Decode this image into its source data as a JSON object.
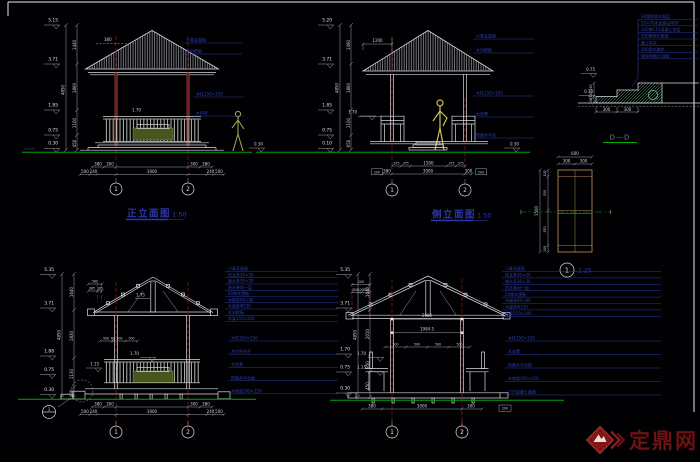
{
  "views": {
    "front": {
      "title": "正立面图",
      "scale": "1:50",
      "levels": [
        "5.15",
        "3.71",
        "1.85",
        "0.75",
        "0.30"
      ],
      "vtotal": "4850",
      "vdims": [
        "1440",
        "1860",
        "1100",
        "450"
      ],
      "roof_dim": "380",
      "rail_level": "1.70",
      "ground_left": "±0.00",
      "ground_right": "0.30",
      "hdims1": [
        "380",
        "300",
        "300",
        "380"
      ],
      "hdims2": [
        "500",
        "240",
        "3000",
        "240",
        "500"
      ],
      "axes": [
        "1",
        "2"
      ],
      "notes_roof": [
        "小青瓦屋面",
        "木封檐板"
      ],
      "notes_body": [
        "木柱150×150",
        "木栏杆"
      ]
    },
    "side": {
      "title": "侧立面图",
      "scale": "1:50",
      "levels": [
        "5.20",
        "3.71",
        "1.85",
        "0.75",
        "0.10"
      ],
      "vtotal": "4850",
      "vdims": [
        "1490",
        "1860",
        "1100",
        "650"
      ],
      "overhang": "1200",
      "rail_level": "1.70",
      "ground_right": "0.30",
      "hdims1": [
        "375",
        "375",
        "1500",
        "375",
        "375"
      ],
      "hdims2": [
        "380",
        "3000",
        "300"
      ],
      "end_box": "200",
      "axes": [
        "1",
        "2"
      ],
      "notes_roof": [
        "小青瓦屋面",
        "木封檐板"
      ],
      "notes_body": [
        "木柱150×150",
        "木坐凳",
        "防腐木平台"
      ]
    },
    "stair": {
      "title": "D—D",
      "levels": [
        "0.75",
        "0.30"
      ],
      "hdims": [
        "300",
        "300"
      ],
      "vdims": [
        "150",
        "150",
        "150"
      ],
      "notes": [
        "30厚防腐木面层",
        "50×70木龙骨@400",
        "100厚C15混凝土垫层",
        "150厚碎石垫层",
        "素土夯实",
        "300宽木踏步",
        "绿化种植土回填"
      ]
    },
    "column": {
      "bubble": "1",
      "scale": "1:25",
      "top_total": "600",
      "top_dims": [
        "300",
        "300"
      ],
      "side_total": "1500",
      "side_dims": [
        "100",
        "550",
        "550",
        "100"
      ]
    },
    "sec1": {
      "levels": [
        "5.35",
        "3.71",
        "1.88",
        "0.75",
        "0.30"
      ],
      "vtotal": "4850",
      "vdims": [
        "1640",
        "1830",
        "1130",
        "450"
      ],
      "top_dim": "560",
      "top_dims": [
        "385",
        "165"
      ],
      "slope": "1.75",
      "mid_dims": [
        "500",
        "60",
        "500",
        "500"
      ],
      "rail_levels": [
        "1.70",
        "1.15"
      ],
      "hdims1": [
        "380",
        "300",
        "300",
        "380"
      ],
      "hdims2": [
        "500",
        "240",
        "3000",
        "240",
        "500"
      ],
      "axes": [
        "1",
        "2"
      ],
      "detail_bubble": "1",
      "notes_roof": [
        "小青瓦屋面",
        "挂瓦条30×30",
        "顺水条30×30",
        "防水卷材一层",
        "20厚木望板",
        "木椽条60×80",
        "木檩条Φ120",
        "木封檐板",
        "木梁150×200"
      ],
      "notes_body": [
        "木柱150×150",
        "木栏杆扶手",
        "木坐凳",
        "防腐木平台板",
        "木地梁100×150"
      ]
    },
    "sec2": {
      "levels": [
        "5.35",
        "3.71",
        "1.70",
        "0.75",
        "0.30"
      ],
      "vtotal": "4850",
      "vdims": [
        "1640",
        "2010",
        "950",
        "450"
      ],
      "top_dim": "100",
      "top_dims": [
        "300",
        "100",
        "300"
      ],
      "inner_dims": [
        "2000",
        "1984.5"
      ],
      "seat_dims": [
        "500",
        "500",
        "500",
        "500"
      ],
      "rail_levels": [
        "1.70",
        "1.15"
      ],
      "hdims": [
        "380",
        "3000",
        "300"
      ],
      "end_box": "200",
      "axes": [
        "1",
        "2"
      ],
      "notes_roof": [
        "小青瓦屋面",
        "挂瓦条30×30",
        "顺水条30×30",
        "防水卷材一层",
        "20厚木望板",
        "木椽条60×80",
        "木檩条Φ120",
        "木梁150×200"
      ],
      "notes_body": [
        "木柱150×150",
        "木坐凳",
        "防腐木平台板",
        "木地梁100×150",
        "C15混凝土基础"
      ]
    }
  },
  "logo": {
    "text": "定鼎网"
  }
}
